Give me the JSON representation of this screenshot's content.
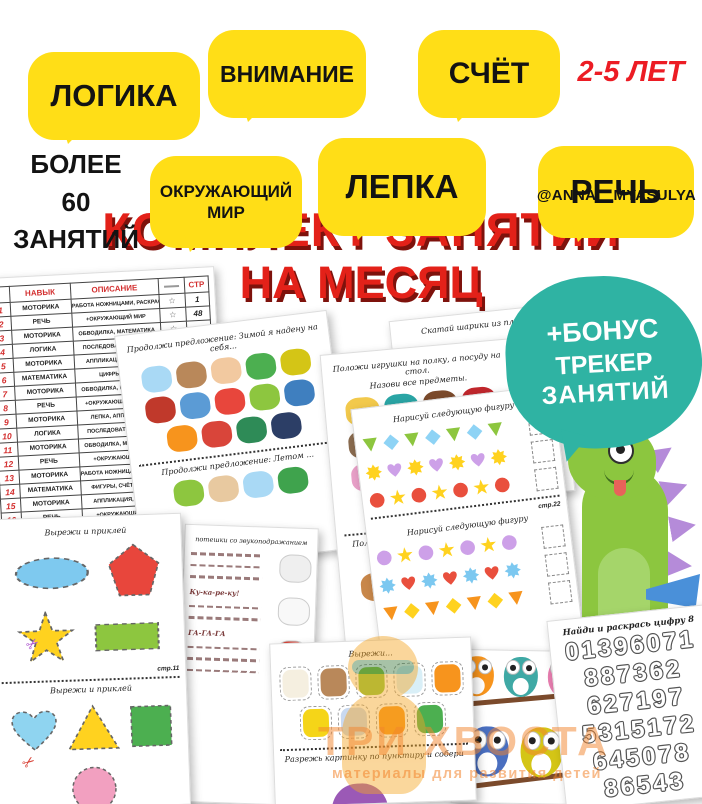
{
  "colors": {
    "bubble_yellow": "#FFDE17",
    "title_red": "#E32119",
    "age_red": "#EC1C24",
    "bonus_teal": "#2FB3A3",
    "table_red": "#D32F2F",
    "watermark_orange": "#F2842C"
  },
  "icons": {
    "star_outline": "☆",
    "scissors": "✂"
  },
  "poster": {
    "badges_row1": [
      {
        "label": "ЛОГИКА"
      },
      {
        "label": "ВНИМАНИЕ"
      },
      {
        "label": "СЧЁТ"
      }
    ],
    "age": "2-5 ЛЕТ",
    "count_lines": [
      "БОЛЕЕ",
      "60",
      "ЗАНЯТИЙ"
    ],
    "badges_row2": [
      {
        "label": "ОКРУЖАЮЩИЙ МИР"
      },
      {
        "label": "ЛЕПКА"
      },
      {
        "label": "РЕЧЬ"
      }
    ],
    "handle": "@ANNA__MYASULYA",
    "title_line1": "КОМПЛЕКТ ЗАНЯТИЙ",
    "title_line2": "НА МЕСЯЦ",
    "bonus_lines": [
      "+БОНУС",
      "ТРЕКЕР",
      "ЗАНЯТИЙ"
    ]
  },
  "watermark": {
    "brand": "ТРИ ХВОСТА",
    "tagline": "материалы для развития детей"
  },
  "skills_table": {
    "col_headers": {
      "skill": "НАВЫК",
      "desc": "ОПИСАНИЕ",
      "page": "СТР"
    },
    "rows": [
      {
        "n": "1",
        "skill": "МОТОРИКА",
        "desc": "РАБОТА НОЖНИЦАМИ, РАСКРАСКА",
        "page": "1"
      },
      {
        "n": "2",
        "skill": "РЕЧЬ",
        "desc": "+ОКРУЖАЮЩИЙ МИР",
        "page": "48"
      },
      {
        "n": "3",
        "skill": "МОТОРИКА",
        "desc": "ОБВОДИЛКА, МАТЕМАТИКА",
        "page": ""
      },
      {
        "n": "4",
        "skill": "ЛОГИКА",
        "desc": "ПОСЛЕДОВАТЕЛЬНОСТЬ",
        "page": ""
      },
      {
        "n": "5",
        "skill": "МОТОРИКА",
        "desc": "АППЛИКАЦИЯ, ЛОГИКА",
        "page": ""
      },
      {
        "n": "6",
        "skill": "МАТЕМАТИКА",
        "desc": "ЦИФРЫ, СЧЁТ",
        "page": ""
      },
      {
        "n": "7",
        "skill": "МОТОРИКА",
        "desc": "ОБВОДИЛКА, МАТЕМАТИКА",
        "page": ""
      },
      {
        "n": "8",
        "skill": "РЕЧЬ",
        "desc": "+ОКРУЖАЮЩИЙ МИР, Л...",
        "page": ""
      },
      {
        "n": "9",
        "skill": "МОТОРИКА",
        "desc": "ЛЕПКА, АППЛИКАЦИЯ",
        "page": ""
      },
      {
        "n": "10",
        "skill": "ЛОГИКА",
        "desc": "ПОСЛЕДОВАТЕЛЬНОСТЬ",
        "page": ""
      },
      {
        "n": "11",
        "skill": "МОТОРИКА",
        "desc": "ОБВОДИЛКА, МАТЕМАТИКА",
        "page": ""
      },
      {
        "n": "12",
        "skill": "РЕЧЬ",
        "desc": "+ОКРУЖАЮЩИЙ МИР",
        "page": ""
      },
      {
        "n": "13",
        "skill": "МОТОРИКА",
        "desc": "РАБОТА НОЖНИЦАМИ, РАСКРАСКА",
        "page": ""
      },
      {
        "n": "14",
        "skill": "МАТЕМАТИКА",
        "desc": "ФИГУРЫ, СЧЁТ, ЛОГИКА",
        "page": ""
      },
      {
        "n": "15",
        "skill": "МОТОРИКА",
        "desc": "АППЛИКАЦИЯ, ЛОГИКА",
        "page": ""
      },
      {
        "n": "16",
        "skill": "РЕЧЬ",
        "desc": "+ОКРУЖАЮЩИЙ МИР",
        "page": ""
      },
      {
        "n": "17",
        "skill": "МОТОРИКА",
        "desc": "АППЛИКАЦИЯ, ЛЕПКА",
        "page": ""
      },
      {
        "n": "18",
        "skill": "ЛОГИКА",
        "desc": "ПОСЛЕДОВАТЕЛЬНОСТЬ",
        "page": ""
      }
    ]
  },
  "worksheets": {
    "clothes": {
      "title1": "Продолжи предложение: Зимой я надену на себя...",
      "title2": "Продолжи предложение: Летом ...",
      "items1": [
        {
          "name": "blue-sweater",
          "color": "#A9D9F5"
        },
        {
          "name": "brown-dress",
          "color": "#B9885A"
        },
        {
          "name": "boy",
          "color": "#F2C9A0"
        },
        {
          "name": "green-scarf",
          "color": "#4CAF50"
        },
        {
          "name": "yellow-sweater",
          "color": "#D4C516"
        },
        {
          "name": "red-vest",
          "color": "#C0392B"
        },
        {
          "name": "blue-mittens",
          "color": "#5B9BD5"
        },
        {
          "name": "red-jacket",
          "color": "#E8463C"
        },
        {
          "name": "green-pants",
          "color": "#8DC63F"
        },
        {
          "name": "blue-shorts",
          "color": "#3F7FBF"
        },
        {
          "name": "orange-socks",
          "color": "#F7941D"
        },
        {
          "name": "red-sweater",
          "color": "#D9453A"
        },
        {
          "name": "green-hat",
          "color": "#2E8B57"
        },
        {
          "name": "navy-jacket",
          "color": "#2C3E66"
        }
      ],
      "items2": [
        {
          "name": "green-pants",
          "color": "#8DC63F"
        },
        {
          "name": "doll",
          "color": "#E8C9A0"
        },
        {
          "name": "blue-sweater",
          "color": "#A9D9F5"
        },
        {
          "name": "boy-in-cap",
          "color": "#3FA34D"
        }
      ]
    },
    "toys": {
      "title1": "Положи игрушки на полку, а посуду на стол.",
      "sub1": "Назови все предметы.",
      "title2": "Положи обувь на полку, а одежду на вешалку.",
      "sub2": "Назови все вещи.",
      "items1": [
        {
          "name": "duck",
          "color": "#F2C94C"
        },
        {
          "name": "frying-pan",
          "color": "#2AA5A5"
        },
        {
          "name": "shelf",
          "color": "#7B4A2B"
        },
        {
          "name": "drum",
          "color": "#C1272D"
        },
        {
          "name": "whisk",
          "color": "#8A6B4F"
        },
        {
          "name": "toy-cubes",
          "color": "#B85AC8"
        },
        {
          "name": "bowl",
          "color": "#3FA9A5"
        },
        {
          "name": "table",
          "color": "#8B5A2B"
        },
        {
          "name": "cupcake",
          "color": "#E8A0C8"
        },
        {
          "name": "teapot",
          "color": "#5BC8C0"
        },
        {
          "name": "cup",
          "color": "#A0522D"
        },
        {
          "name": "pyramid",
          "color": "#E87E2B"
        },
        {
          "name": "spinning-top",
          "color": "#5B9BD5"
        }
      ],
      "items2": [
        {
          "name": "slippers",
          "color": "#C8874A"
        },
        {
          "name": "coat-rack",
          "color": "#6B3F23"
        },
        {
          "name": "heel-shoe",
          "color": "#2AA5A5"
        },
        {
          "name": "shoe-shelf",
          "color": "#5C3317"
        },
        {
          "name": "boot",
          "color": "#3A2A20"
        },
        {
          "name": "green-pants",
          "color": "#8DC63F"
        },
        {
          "name": "t-shirt",
          "color": "#B9804A"
        }
      ]
    },
    "tiger": {
      "title": "Скатай шарики из пла..."
    },
    "patterns": {
      "title": "Нарисуй следующую фигуру",
      "page_label": "стр.22",
      "section1": [
        {
          "a": "triangle|#8DC63F",
          "b": "diamond|#8ED3F5"
        },
        {
          "a": "flower|#FFD21F",
          "b": "heart|#CDA0E8"
        },
        {
          "a": "circle|#E94F3D",
          "b": "star|#FFD21F"
        }
      ],
      "section2": [
        {
          "a": "circle|#CDA0E8",
          "b": "star|#FFD21F"
        },
        {
          "a": "flower|#7CC8F0",
          "b": "heart|#E94F3D"
        },
        {
          "a": "triangle|#F7941D",
          "b": "diamond|#FFD21F"
        }
      ]
    },
    "cut_shapes": {
      "title": "Вырежи и приклей",
      "page1_label": "стр.11",
      "page2_label": "стр.12",
      "set1": [
        {
          "shape": "ellipse",
          "color": "#7EC9EF"
        },
        {
          "shape": "pentagon",
          "color": "#E8463C"
        },
        {
          "shape": "star",
          "color": "#FFD21F"
        },
        {
          "shape": "rect",
          "color": "#8DC63F"
        }
      ],
      "set2": [
        {
          "shape": "heart",
          "color": "#8FD4F0"
        },
        {
          "shape": "triangle-up",
          "color": "#FFD21F"
        },
        {
          "shape": "square",
          "color": "#4CAF50"
        },
        {
          "shape": "circle",
          "color": "#F2A0C0"
        }
      ]
    },
    "rhymes": {
      "title": "потешки со звукоподражанием",
      "fragments": [
        "Ку-ка-ре-ку!",
        "ГА-ГА-ГА"
      ],
      "animals": [
        {
          "name": "hen",
          "color": "#EFEFEF"
        },
        {
          "name": "goose",
          "color": "#F8F8F8"
        },
        {
          "name": "rooster",
          "color": "#D9453A"
        },
        {
          "name": "cat",
          "color": "#F5B041"
        },
        {
          "name": "dog",
          "color": "#B9885A"
        }
      ]
    },
    "food": {
      "title": "Вырежи...",
      "cut_line": "Разрежь картинку по пунктиру и собери",
      "items": [
        {
          "name": "egg",
          "color": "#F5EFE0"
        },
        {
          "name": "toast",
          "color": "#B9885A"
        },
        {
          "name": "avocado",
          "color": "#8DC63F"
        },
        {
          "name": "milk",
          "color": "#D9EFF7"
        },
        {
          "name": "glass-of-juice",
          "color": "#F7941D"
        },
        {
          "name": "fried-egg",
          "color": "#F5D518"
        },
        {
          "name": "cereal-bowl",
          "color": "#C9D9F0"
        },
        {
          "name": "carrot",
          "color": "#F7941D"
        },
        {
          "name": "broccoli",
          "color": "#4CAF50"
        }
      ]
    },
    "numbers": {
      "title": "Найди и раскрась цифру 8",
      "rows": [
        "01396071",
        "887362",
        "627197",
        "5315172",
        "645078",
        "86543"
      ]
    },
    "owls": {
      "colors": [
        "#F7941D",
        "#3FA9A5",
        "#E87EB0",
        "#4A6FC0",
        "#D4C516"
      ]
    }
  }
}
